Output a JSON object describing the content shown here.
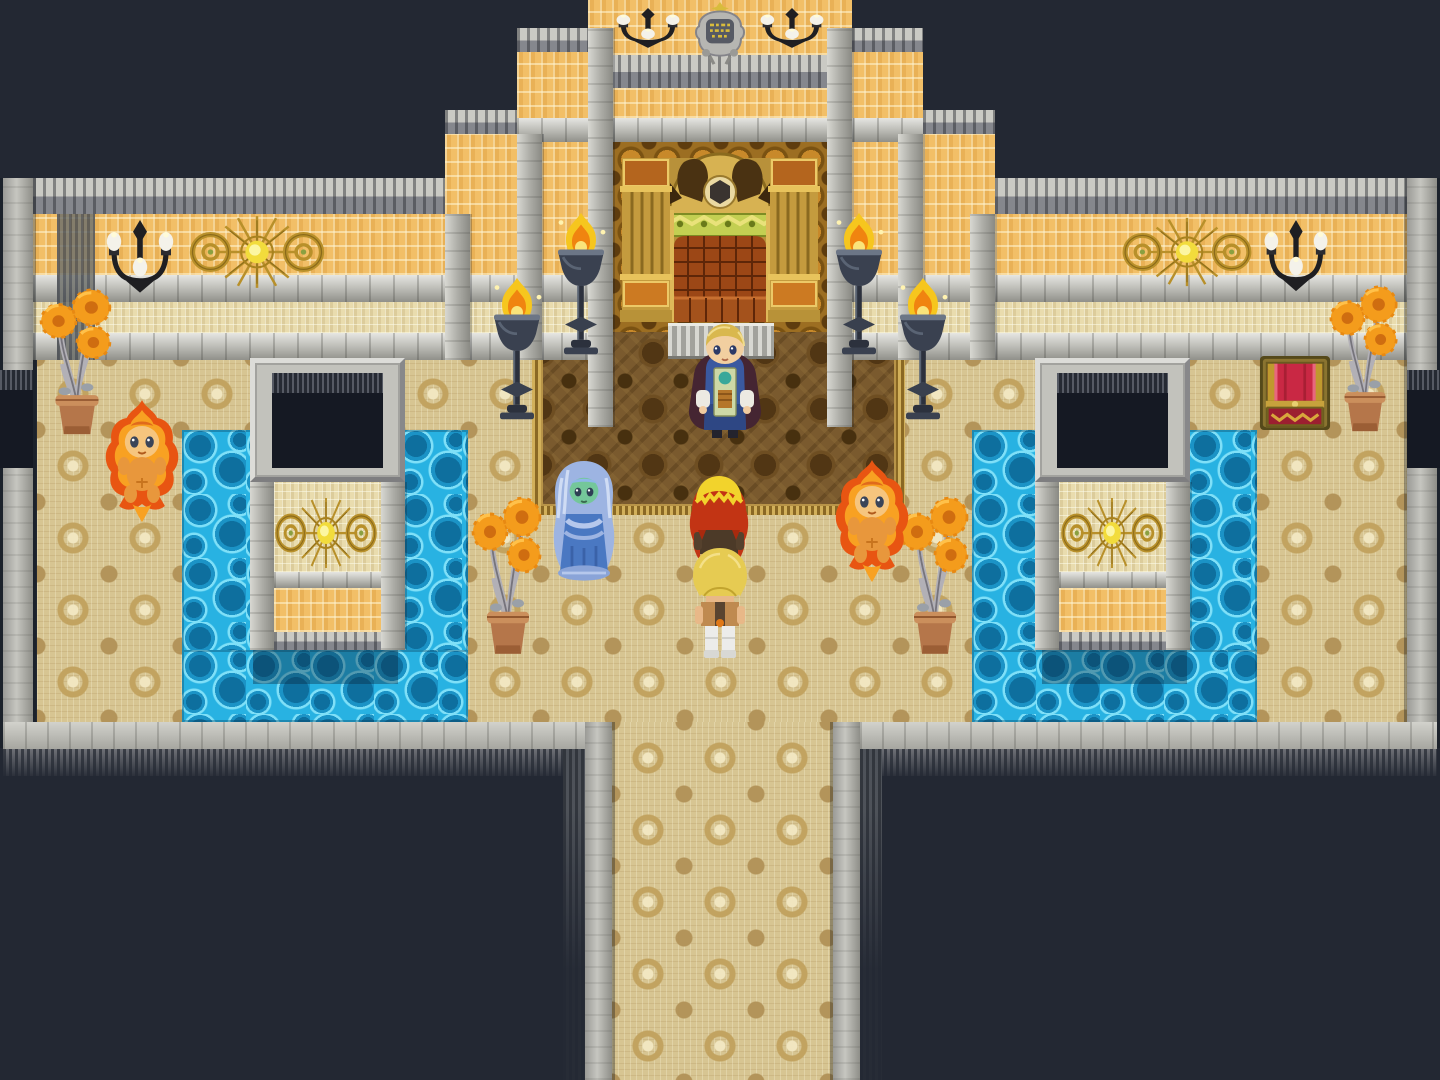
{
  "scene": {
    "name": "throne-room",
    "description": "Top-down pixel-art RPG throne room scene with a king before a golden throne, two party members, a water spirit, two fire spirits, braziers, wall ornaments, reflecting pools and a treasure chest.",
    "palette": {
      "background": "#232833",
      "floor": "#d7c592",
      "water": "#28b2e2",
      "wall_orange": "#f2bf67",
      "wall_light": "#e9dcae",
      "stone": "#b8b8b2",
      "carpet": "#7a5a2e",
      "gold": "#c79a2e",
      "flame": "#f6c61e",
      "chest_red": "#c92844"
    }
  },
  "map": {
    "regions": [
      {
        "name": "floor-main",
        "kind": "floor",
        "x": 37,
        "y": 358,
        "w": 1370,
        "h": 364
      },
      {
        "name": "corridor-floor",
        "kind": "floor",
        "x": 612,
        "y": 722,
        "w": 221,
        "h": 358
      },
      {
        "name": "pool-left-west",
        "kind": "water",
        "x": 182,
        "y": 430,
        "w": 71,
        "h": 292
      },
      {
        "name": "pool-left-east",
        "kind": "water",
        "x": 398,
        "y": 430,
        "w": 70,
        "h": 292
      },
      {
        "name": "pool-left-south",
        "kind": "water",
        "x": 182,
        "y": 650,
        "w": 286,
        "h": 72
      },
      {
        "name": "pool-right-west",
        "kind": "water",
        "x": 972,
        "y": 430,
        "w": 70,
        "h": 292
      },
      {
        "name": "pool-right-east",
        "kind": "water",
        "x": 1187,
        "y": 430,
        "w": 70,
        "h": 292
      },
      {
        "name": "pool-right-south",
        "kind": "water",
        "x": 972,
        "y": 650,
        "w": 285,
        "h": 72
      },
      {
        "name": "pool-left-pillar-shadow",
        "kind": "watershadow",
        "x": 253,
        "y": 650,
        "w": 145,
        "h": 34
      },
      {
        "name": "pool-right-pillar-shadow",
        "kind": "watershadow",
        "x": 1042,
        "y": 650,
        "w": 145,
        "h": 34
      },
      {
        "name": "throne-carpet",
        "kind": "carpet",
        "x": 532,
        "y": 288,
        "w": 373,
        "h": 227
      },
      {
        "name": "tower-top-wall",
        "kind": "wallOrange",
        "x": 588,
        "y": 0,
        "w": 264,
        "h": 55
      },
      {
        "name": "tower-gray-band",
        "kind": "grayCap",
        "x": 588,
        "y": 55,
        "w": 264,
        "h": 33
      },
      {
        "name": "tower-mid-wall",
        "kind": "wallOrange",
        "x": 588,
        "y": 88,
        "w": 264,
        "h": 30
      },
      {
        "name": "throne-backdrop",
        "kind": "goldwall",
        "x": 613,
        "y": 142,
        "w": 215,
        "h": 190
      },
      {
        "name": "step2-left-cap",
        "kind": "grayCap",
        "x": 517,
        "y": 28,
        "w": 71,
        "h": 24
      },
      {
        "name": "step2-left-wall",
        "kind": "wallOrange",
        "x": 517,
        "y": 52,
        "w": 71,
        "h": 223
      },
      {
        "name": "step2-right-cap",
        "kind": "grayCap",
        "x": 852,
        "y": 28,
        "w": 71,
        "h": 24
      },
      {
        "name": "step2-right-wall",
        "kind": "wallOrange",
        "x": 852,
        "y": 52,
        "w": 71,
        "h": 223
      },
      {
        "name": "tower-ledge",
        "kind": "ledge",
        "x": 517,
        "y": 118,
        "w": 406,
        "h": 24
      },
      {
        "name": "step3-left-cap",
        "kind": "grayCap",
        "x": 445,
        "y": 110,
        "w": 72,
        "h": 24
      },
      {
        "name": "step3-left-wall",
        "kind": "wallOrange",
        "x": 445,
        "y": 134,
        "w": 72,
        "h": 141
      },
      {
        "name": "step3-right-cap",
        "kind": "grayCap",
        "x": 923,
        "y": 110,
        "w": 72,
        "h": 24
      },
      {
        "name": "step3-right-wall",
        "kind": "wallOrange",
        "x": 923,
        "y": 134,
        "w": 72,
        "h": 141
      },
      {
        "name": "wing-left-cap",
        "kind": "grayCap",
        "x": 33,
        "y": 178,
        "w": 412,
        "h": 36
      },
      {
        "name": "wing-left-wall",
        "kind": "wallOrange",
        "x": 33,
        "y": 214,
        "w": 412,
        "h": 61
      },
      {
        "name": "wing-right-cap",
        "kind": "grayCap",
        "x": 995,
        "y": 178,
        "w": 412,
        "h": 36
      },
      {
        "name": "wing-right-wall",
        "kind": "wallOrange",
        "x": 995,
        "y": 214,
        "w": 412,
        "h": 61
      },
      {
        "name": "ledge-row-left",
        "kind": "ledge",
        "x": 33,
        "y": 275,
        "w": 555,
        "h": 27
      },
      {
        "name": "lightband-left",
        "kind": "wallLight",
        "x": 33,
        "y": 302,
        "w": 555,
        "h": 31
      },
      {
        "name": "ledge2-left",
        "kind": "ledge",
        "x": 33,
        "y": 333,
        "w": 555,
        "h": 27
      },
      {
        "name": "ledge-row-right",
        "kind": "ledge",
        "x": 852,
        "y": 275,
        "w": 555,
        "h": 27
      },
      {
        "name": "lightband-right",
        "kind": "wallLight",
        "x": 852,
        "y": 302,
        "w": 555,
        "h": 31
      },
      {
        "name": "ledge2-right",
        "kind": "ledge",
        "x": 852,
        "y": 333,
        "w": 555,
        "h": 27
      },
      {
        "name": "wing-left-corner-shade",
        "kind": "fringeV",
        "x": 57,
        "y": 214,
        "w": 38,
        "h": 146
      },
      {
        "name": "pilaster-inner-left",
        "kind": "pilaster",
        "x": 588,
        "y": 28,
        "w": 25,
        "h": 399
      },
      {
        "name": "pilaster-inner-right",
        "kind": "pilaster",
        "x": 827,
        "y": 28,
        "w": 25,
        "h": 399
      },
      {
        "name": "pilaster-mid-left",
        "kind": "pilaster",
        "x": 517,
        "y": 134,
        "w": 25,
        "h": 226
      },
      {
        "name": "pilaster-mid-right",
        "kind": "pilaster",
        "x": 898,
        "y": 134,
        "w": 25,
        "h": 226
      },
      {
        "name": "pilaster-outer-left",
        "kind": "pilaster",
        "x": 445,
        "y": 214,
        "w": 25,
        "h": 146
      },
      {
        "name": "pilaster-outer-right",
        "kind": "pilaster",
        "x": 970,
        "y": 214,
        "w": 25,
        "h": 146
      },
      {
        "name": "pillar-left-frame",
        "kind": "stoneFrame",
        "x": 250,
        "y": 358,
        "w": 155,
        "h": 124
      },
      {
        "name": "pillar-left-window",
        "kind": "window",
        "x": 272,
        "y": 373,
        "w": 111,
        "h": 95
      },
      {
        "name": "pillar-left-col-west",
        "kind": "pilaster",
        "x": 250,
        "y": 482,
        "w": 24,
        "h": 168
      },
      {
        "name": "pillar-left-col-east",
        "kind": "pilaster",
        "x": 381,
        "y": 482,
        "w": 24,
        "h": 168
      },
      {
        "name": "pillar-left-wall",
        "kind": "wallLight",
        "x": 274,
        "y": 482,
        "w": 107,
        "h": 90
      },
      {
        "name": "pillar-left-ledge",
        "kind": "ledge",
        "x": 274,
        "y": 572,
        "w": 107,
        "h": 16
      },
      {
        "name": "pillar-left-goldband",
        "kind": "wallOrange",
        "x": 274,
        "y": 588,
        "w": 107,
        "h": 44
      },
      {
        "name": "pillar-left-base",
        "kind": "grayCap",
        "x": 274,
        "y": 632,
        "w": 107,
        "h": 18
      },
      {
        "name": "pillar-right-frame",
        "kind": "stoneFrame",
        "x": 1035,
        "y": 358,
        "w": 155,
        "h": 124
      },
      {
        "name": "pillar-right-window",
        "kind": "window",
        "x": 1057,
        "y": 373,
        "w": 111,
        "h": 95
      },
      {
        "name": "pillar-right-col-west",
        "kind": "pilaster",
        "x": 1035,
        "y": 482,
        "w": 24,
        "h": 168
      },
      {
        "name": "pillar-right-col-east",
        "kind": "pilaster",
        "x": 1166,
        "y": 482,
        "w": 24,
        "h": 168
      },
      {
        "name": "pillar-right-wall",
        "kind": "wallLight",
        "x": 1059,
        "y": 482,
        "w": 107,
        "h": 90
      },
      {
        "name": "pillar-right-ledge",
        "kind": "ledge",
        "x": 1059,
        "y": 572,
        "w": 107,
        "h": 16
      },
      {
        "name": "pillar-right-goldband",
        "kind": "wallOrange",
        "x": 1059,
        "y": 588,
        "w": 107,
        "h": 44
      },
      {
        "name": "pillar-right-base",
        "kind": "grayCap",
        "x": 1059,
        "y": 632,
        "w": 107,
        "h": 18
      },
      {
        "name": "border-west",
        "kind": "borderV",
        "x": 3,
        "y": 178,
        "w": 30,
        "h": 570
      },
      {
        "name": "border-east",
        "kind": "borderV",
        "x": 1407,
        "y": 178,
        "w": 30,
        "h": 570
      },
      {
        "name": "edge-window-west",
        "kind": "window",
        "x": 0,
        "y": 370,
        "w": 33,
        "h": 98
      },
      {
        "name": "edge-window-east",
        "kind": "window",
        "x": 1407,
        "y": 370,
        "w": 33,
        "h": 98
      },
      {
        "name": "corridor-wall-west",
        "kind": "borderV",
        "x": 585,
        "y": 722,
        "w": 27,
        "h": 358
      },
      {
        "name": "corridor-wall-east",
        "kind": "borderV",
        "x": 833,
        "y": 722,
        "w": 27,
        "h": 358
      },
      {
        "name": "bottom-wall-left",
        "kind": "bottomWall",
        "x": 3,
        "y": 722,
        "w": 582,
        "h": 27
      },
      {
        "name": "bottom-wall-right",
        "kind": "bottomWall",
        "x": 860,
        "y": 722,
        "w": 577,
        "h": 27
      },
      {
        "name": "bottom-fringe-left",
        "kind": "fringeH",
        "x": 3,
        "y": 749,
        "w": 582,
        "h": 27
      },
      {
        "name": "bottom-fringe-right",
        "kind": "fringeH",
        "x": 860,
        "y": 749,
        "w": 577,
        "h": 27
      },
      {
        "name": "corridor-fringe-west",
        "kind": "fringeV2",
        "x": 563,
        "y": 749,
        "w": 22,
        "h": 331
      },
      {
        "name": "corridor-fringe-east",
        "kind": "fringeV2",
        "x": 860,
        "y": 749,
        "w": 22,
        "h": 331
      },
      {
        "name": "throne-dais",
        "kind": "dais",
        "x": 668,
        "y": 323,
        "w": 106,
        "h": 36
      }
    ],
    "sprites": [
      {
        "name": "royal-crest",
        "kind": "crest",
        "x": 690,
        "y": 2,
        "w": 60,
        "h": 64,
        "interactable": false
      },
      {
        "name": "chandelier-left",
        "kind": "candelabra",
        "x": 612,
        "y": 8,
        "w": 72,
        "h": 56,
        "interactable": false
      },
      {
        "name": "chandelier-right",
        "kind": "candelabra",
        "x": 756,
        "y": 8,
        "w": 72,
        "h": 56,
        "interactable": false
      },
      {
        "name": "sun-ornament-left-wall",
        "kind": "sun",
        "x": 183,
        "y": 210,
        "w": 148,
        "h": 84,
        "interactable": false
      },
      {
        "name": "sun-ornament-right-wall",
        "kind": "sun",
        "x": 1116,
        "y": 212,
        "w": 142,
        "h": 80,
        "interactable": false
      },
      {
        "name": "candelabra-left",
        "kind": "candelabra",
        "x": 102,
        "y": 220,
        "w": 76,
        "h": 102,
        "interactable": false
      },
      {
        "name": "candelabra-right",
        "kind": "candelabra",
        "x": 1260,
        "y": 220,
        "w": 72,
        "h": 100,
        "interactable": false
      },
      {
        "name": "throne",
        "kind": "throne",
        "x": 618,
        "y": 138,
        "w": 204,
        "h": 198,
        "interactable": true
      },
      {
        "name": "torch-left-outer",
        "kind": "torch",
        "x": 485,
        "y": 276,
        "w": 64,
        "h": 150,
        "interactable": false
      },
      {
        "name": "torch-left-inner",
        "kind": "torch",
        "x": 549,
        "y": 211,
        "w": 64,
        "h": 150,
        "interactable": false
      },
      {
        "name": "torch-right-inner",
        "kind": "torch",
        "x": 827,
        "y": 211,
        "w": 64,
        "h": 150,
        "interactable": false
      },
      {
        "name": "torch-right-outer",
        "kind": "torch",
        "x": 891,
        "y": 276,
        "w": 64,
        "h": 150,
        "interactable": false
      },
      {
        "name": "sun-ornament-left-pillar",
        "kind": "sun",
        "x": 270,
        "y": 492,
        "w": 112,
        "h": 82,
        "interactable": false
      },
      {
        "name": "sun-ornament-right-pillar",
        "kind": "sun",
        "x": 1056,
        "y": 492,
        "w": 112,
        "h": 82,
        "interactable": false
      },
      {
        "name": "treasure-chest",
        "kind": "chest",
        "x": 1258,
        "y": 354,
        "w": 74,
        "h": 78,
        "interactable": true
      },
      {
        "name": "potted-plant-far-left",
        "kind": "plant",
        "x": 36,
        "y": 286,
        "w": 82,
        "h": 152,
        "interactable": false
      },
      {
        "name": "potted-plant-center-left",
        "kind": "plant",
        "x": 468,
        "y": 494,
        "w": 80,
        "h": 164,
        "interactable": false
      },
      {
        "name": "potted-plant-center-right",
        "kind": "plant",
        "x": 895,
        "y": 494,
        "w": 80,
        "h": 164,
        "interactable": false
      },
      {
        "name": "potted-plant-far-right",
        "kind": "plant",
        "x": 1326,
        "y": 283,
        "w": 78,
        "h": 152,
        "interactable": false
      },
      {
        "name": "fire-spirit-left",
        "kind": "fireSpirit",
        "x": 100,
        "y": 398,
        "w": 84,
        "h": 128,
        "interactable": true
      },
      {
        "name": "water-spirit",
        "kind": "waterSpirit",
        "x": 544,
        "y": 458,
        "w": 80,
        "h": 124,
        "interactable": true
      },
      {
        "name": "fire-spirit-right",
        "kind": "fireSpirit",
        "x": 830,
        "y": 458,
        "w": 84,
        "h": 128,
        "interactable": true
      },
      {
        "name": "king",
        "kind": "king",
        "x": 682,
        "y": 320,
        "w": 86,
        "h": 120,
        "interactable": true
      },
      {
        "name": "party-member-red-hair",
        "kind": "partyRed",
        "x": 678,
        "y": 470,
        "w": 82,
        "h": 122,
        "interactable": true
      },
      {
        "name": "party-member-blonde",
        "kind": "partyBlonde",
        "x": 680,
        "y": 544,
        "w": 80,
        "h": 114,
        "interactable": true
      }
    ]
  }
}
